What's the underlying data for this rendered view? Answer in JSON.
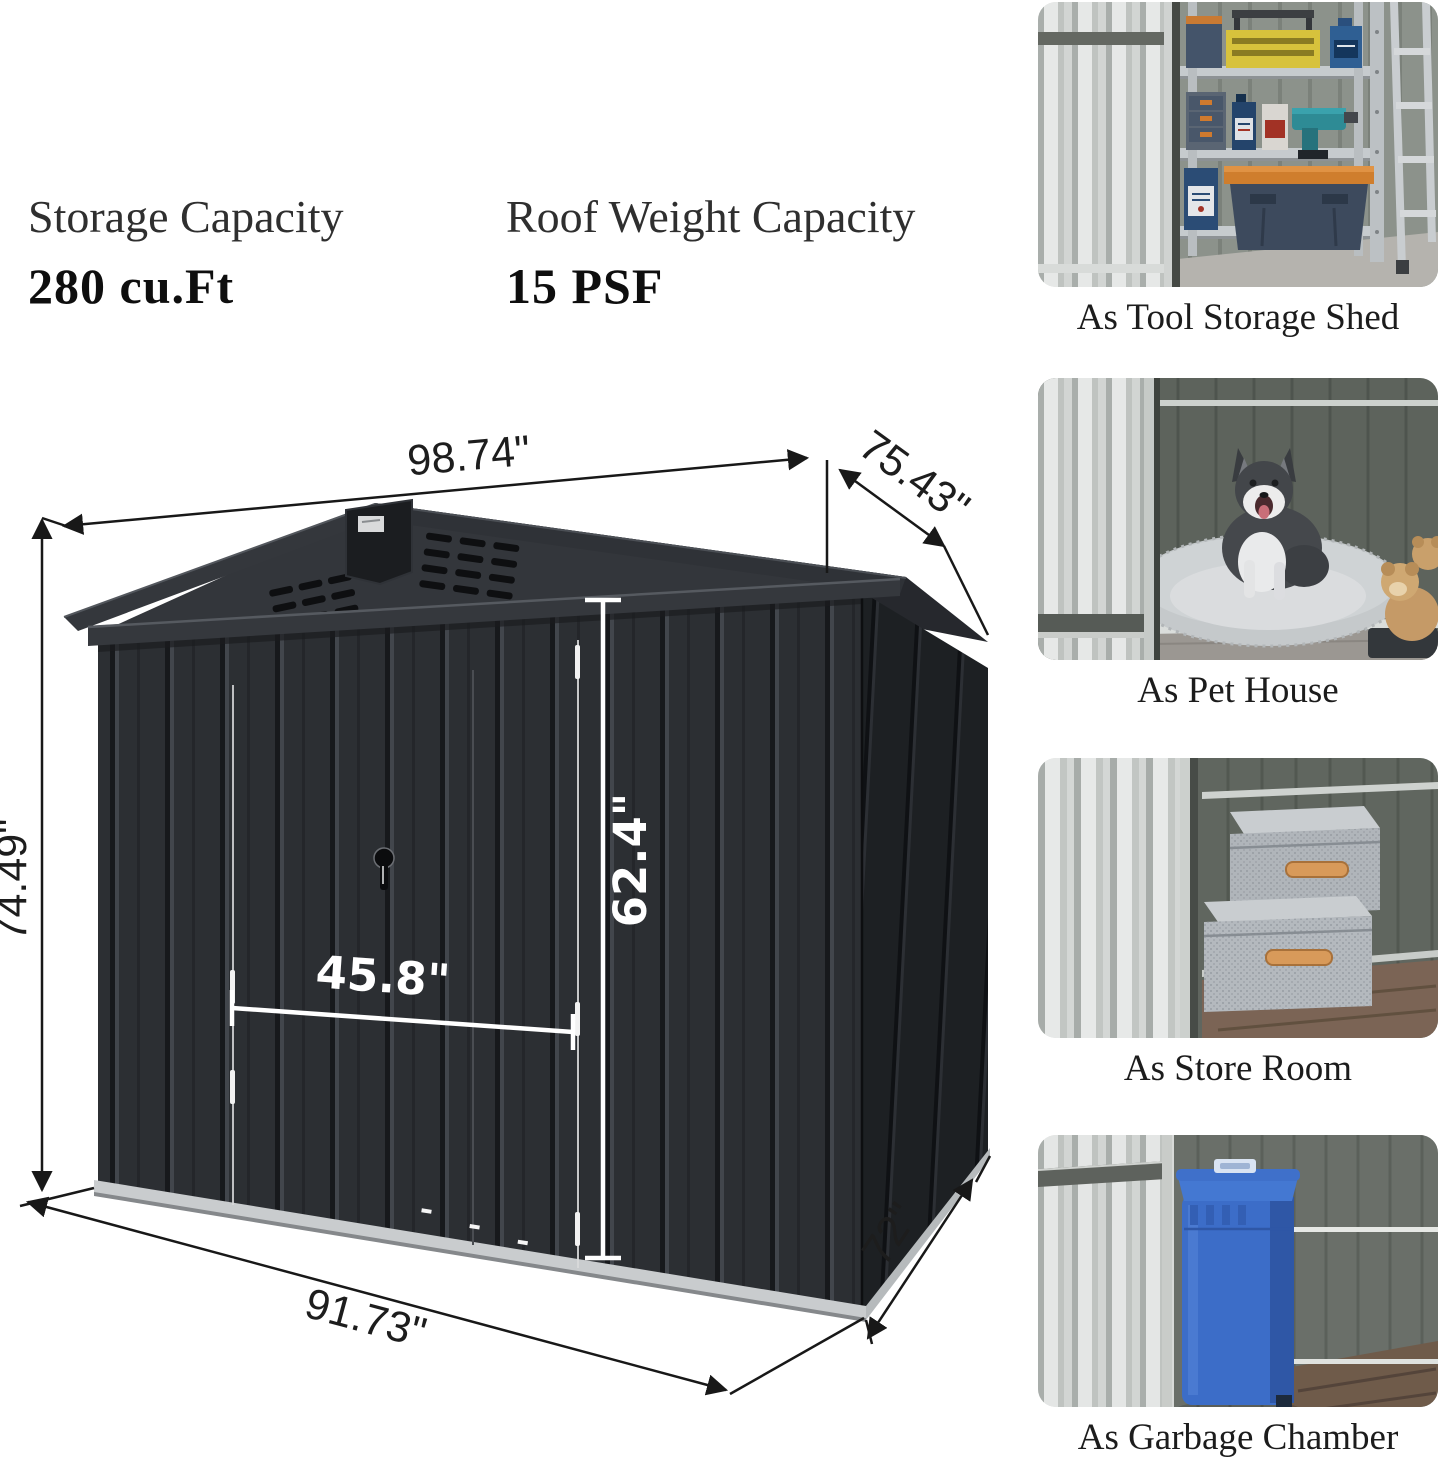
{
  "specs": [
    {
      "label": "Storage Capacity",
      "value": "280 cu.Ft"
    },
    {
      "label": "Roof Weight Capacity",
      "value": "15 PSF"
    }
  ],
  "diagram": {
    "dimensions": {
      "roof_width": "98.74\"",
      "roof_depth": "75.43\"",
      "wall_height": "74.49\"",
      "door_width": "45.8\"",
      "door_height": "62.4\"",
      "base_width": "91.73\"",
      "base_depth": "72\""
    },
    "colors": {
      "shed_front": "#2c2f33",
      "shed_side": "#1d2023",
      "roof": "#303338",
      "base_rail": "#c9ccce",
      "dim_line": "#181818",
      "door_dim": "#ffffff"
    }
  },
  "sidebar": {
    "cards": [
      {
        "caption": "As Tool Storage Shed"
      },
      {
        "caption": "As Pet House"
      },
      {
        "caption": "As Store Room"
      },
      {
        "caption": "As Garbage Chamber"
      }
    ]
  }
}
